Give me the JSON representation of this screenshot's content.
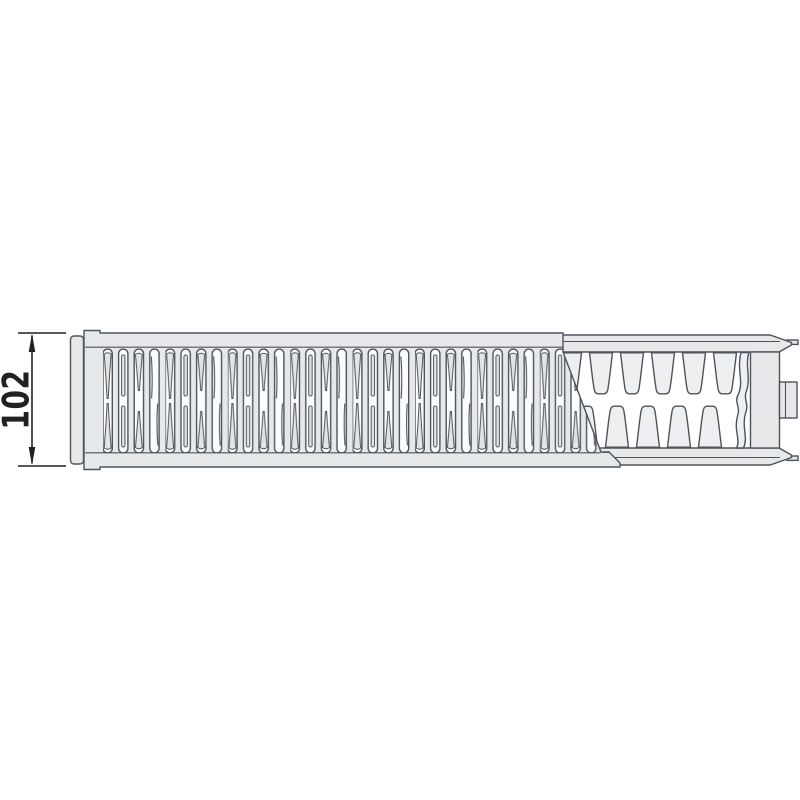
{
  "drawing": {
    "description": "panel radiator top view cutaway",
    "dimension": {
      "label": "102",
      "orientation": "vertical",
      "side": "left"
    }
  },
  "colors": {
    "background": "#ffffff",
    "outline": "#4e545b",
    "body_fill": "#e6e8ea",
    "slot_fill": "#fbfcfd",
    "fin_fill": "#edeff0",
    "slot_fin_detail": "#e2e4e6",
    "dimension": "#212121"
  }
}
